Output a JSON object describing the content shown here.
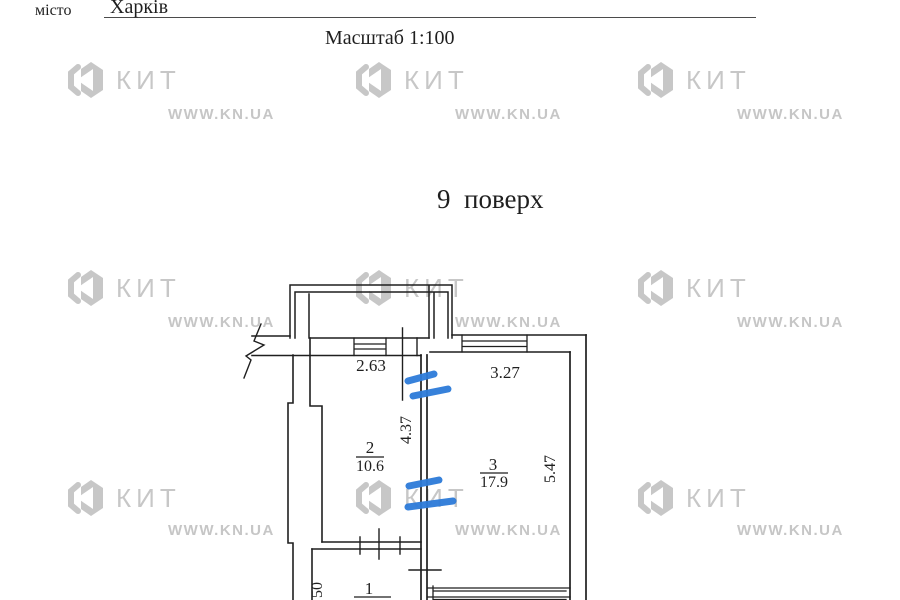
{
  "header": {
    "city_label": "місто",
    "city_value": "Харків",
    "scale": "Масштаб 1:100"
  },
  "floor_title": "9  поверх",
  "watermark": {
    "brand": "КИТ",
    "site": "WWW.KN.UA"
  },
  "plan": {
    "rooms": [
      {
        "number": "2",
        "area": "10.6"
      },
      {
        "number": "3",
        "area": "17.9"
      },
      {
        "number": "1"
      }
    ],
    "dimensions": {
      "top_left": "2.63",
      "top_right": "3.27",
      "middle_vertical": "4.37",
      "right_vertical": "5.47",
      "bottom_left_partial": "50"
    },
    "ink_color": "#1f1f1f",
    "annotation_color": "#2d7bd9",
    "watermark_color": "#c7c7c7"
  }
}
